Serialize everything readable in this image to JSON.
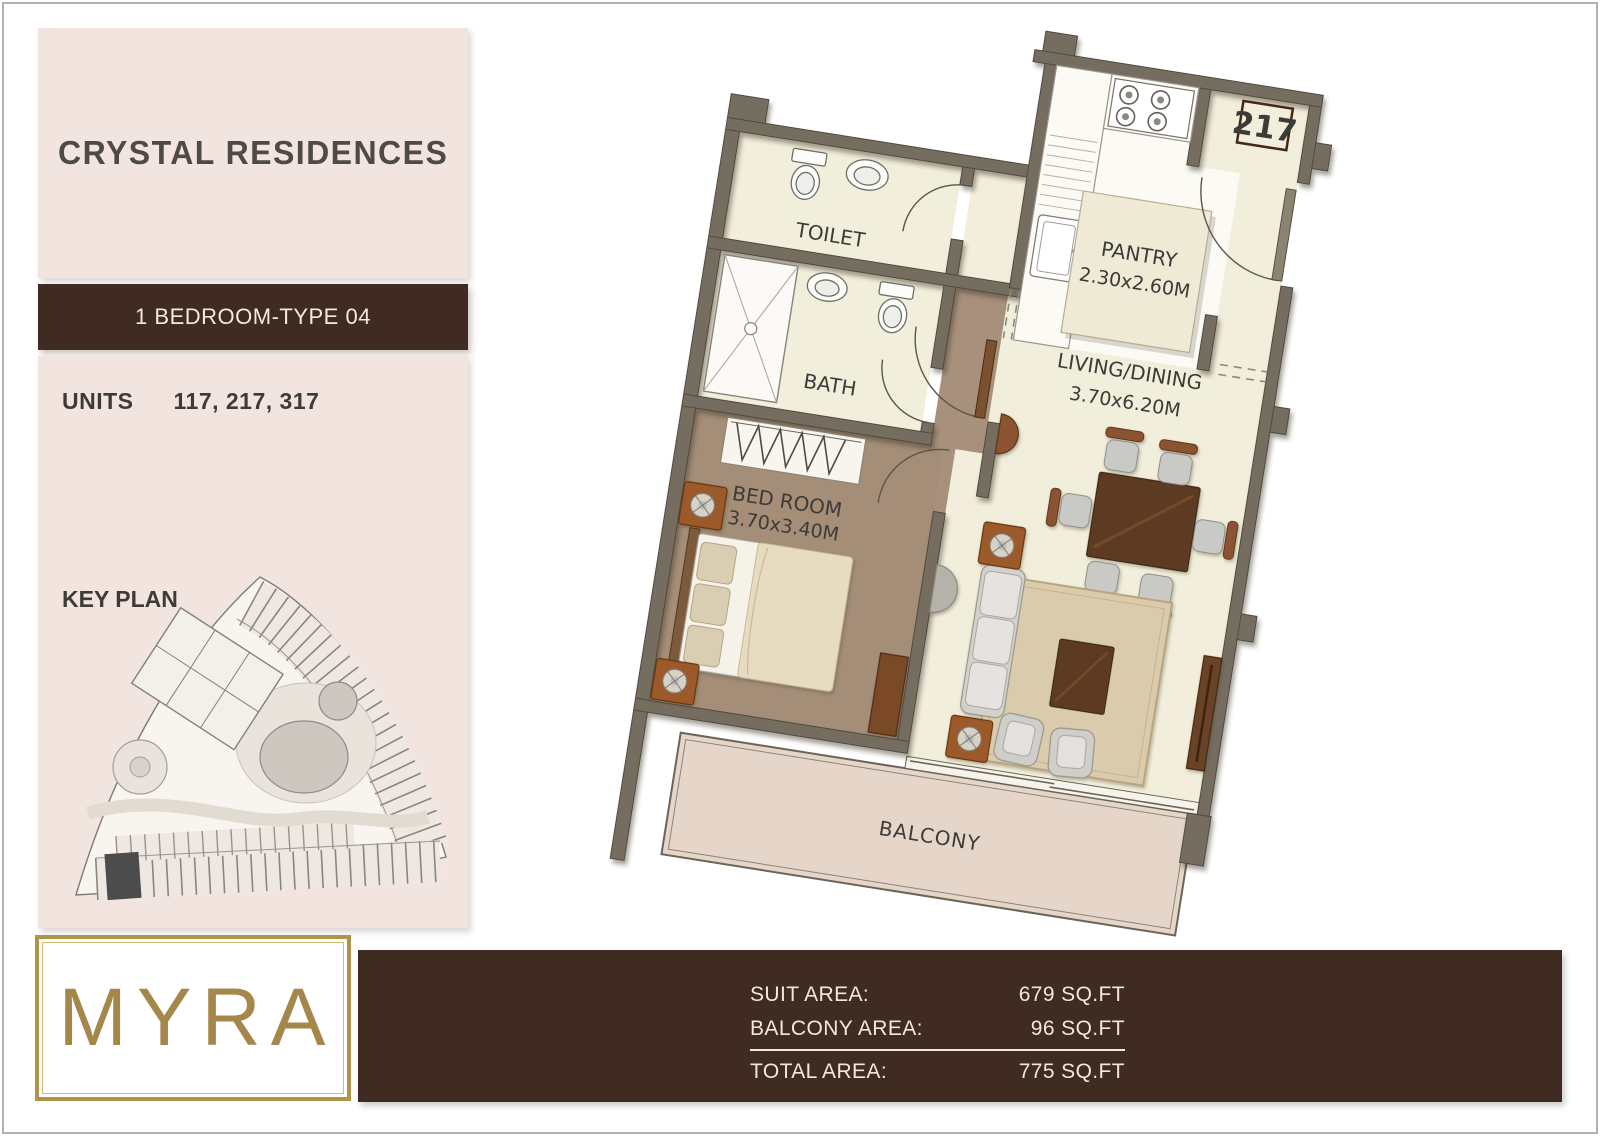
{
  "header": {
    "project_name": "CRYSTAL RESIDENCES",
    "type_label": "1 BEDROOM-TYPE 04",
    "units_label": "UNITS",
    "units_value": "117, 217, 317",
    "key_plan_label": "KEY PLAN"
  },
  "logo": {
    "text": "MYRA"
  },
  "floor_plan": {
    "unit_number": "217",
    "rooms": {
      "toilet": {
        "name": "TOILET"
      },
      "bath": {
        "name": "BATH"
      },
      "bedroom": {
        "name": "BED ROOM",
        "dims": "3.70x3.40M"
      },
      "pantry": {
        "name": "PANTRY",
        "dims": "2.30x2.60M"
      },
      "living": {
        "name": "LIVING/DINING",
        "dims": "3.70x6.20M"
      },
      "balcony": {
        "name": "BALCONY"
      }
    }
  },
  "area_table": {
    "rows": [
      {
        "label": "SUIT AREA:",
        "value": "679 SQ.FT"
      },
      {
        "label": "BALCONY AREA:",
        "value": "96 SQ.FT"
      },
      {
        "label": "TOTAL AREA:",
        "value": "775 SQ.FT"
      }
    ]
  },
  "colors": {
    "accent_brown": "#3f2b21",
    "panel_pink": "#f2e5e0",
    "gold": "#a6874b",
    "wall": "#746e60",
    "room_cream": "#f1eedb",
    "floor_brown": "#a8917c",
    "balcony_floor": "#e6d6c9"
  }
}
